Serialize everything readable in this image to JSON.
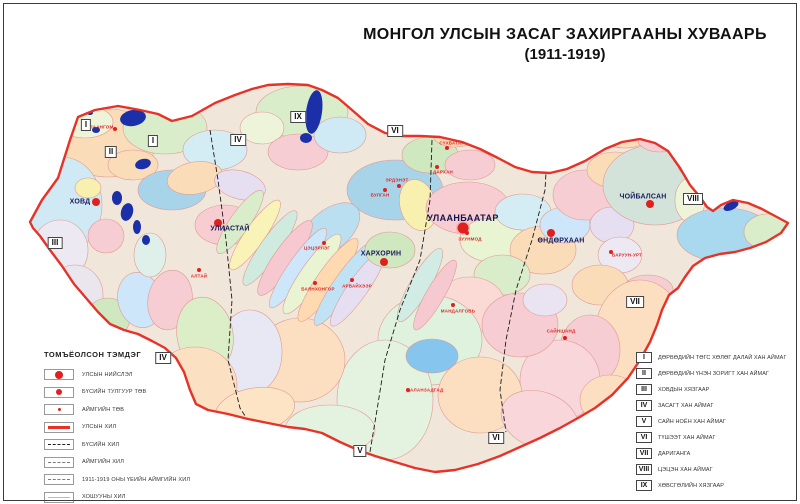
{
  "title": {
    "line1": "МОНГОЛ УЛСЫН ЗАСАГ ЗАХИРГААНЫ ХУВААРЬ",
    "line2": "(1911-1919)"
  },
  "colors": {
    "state_border": "#e63229",
    "city_dot": "#e01f1f",
    "aimag_label": "#e02525",
    "lake": "#1a2fa8"
  },
  "map": {
    "cities": [
      {
        "name": "УЛААНБААТАР",
        "type": "capital",
        "x": 463,
        "y": 228,
        "lx": 463,
        "ly": 218
      },
      {
        "name": "ХОВД",
        "type": "regional",
        "x": 96,
        "y": 202,
        "lx": 80,
        "ly": 202
      },
      {
        "name": "УЛИАСТАЙ",
        "type": "regional",
        "x": 218,
        "y": 223,
        "lx": 230,
        "ly": 229
      },
      {
        "name": "ХАРХОРИН",
        "type": "regional",
        "x": 384,
        "y": 262,
        "lx": 381,
        "ly": 254
      },
      {
        "name": "ӨНДӨРХААН",
        "type": "regional",
        "x": 551,
        "y": 233,
        "lx": 561,
        "ly": 241
      },
      {
        "name": "ЧОЙБАЛСАН",
        "type": "regional",
        "x": 650,
        "y": 204,
        "lx": 643,
        "ly": 197
      },
      {
        "name": "УЛААНГОМ",
        "type": "aimag",
        "x": 115,
        "y": 129,
        "lx": 100,
        "ly": 127
      },
      {
        "name": "АЛТАЙ",
        "type": "aimag",
        "x": 199,
        "y": 270,
        "lx": 199,
        "ly": 276
      },
      {
        "name": "ЦЭЦЭРЛЭГ",
        "type": "aimag",
        "x": 324,
        "y": 243,
        "lx": 317,
        "ly": 248
      },
      {
        "name": "БАЯНХОНГОР",
        "type": "aimag",
        "x": 315,
        "y": 283,
        "lx": 318,
        "ly": 289
      },
      {
        "name": "АРВАЙХЭЭР",
        "type": "aimag",
        "x": 352,
        "y": 280,
        "lx": 357,
        "ly": 286
      },
      {
        "name": "БУЛГАН",
        "type": "aimag",
        "x": 385,
        "y": 190,
        "lx": 380,
        "ly": 195
      },
      {
        "name": "ЭРДЭНЭТ",
        "type": "aimag",
        "x": 399,
        "y": 186,
        "lx": 397,
        "ly": 180
      },
      {
        "name": "СҮХБАТАР",
        "type": "aimag",
        "x": 447,
        "y": 148,
        "lx": 452,
        "ly": 143
      },
      {
        "name": "ДАРХАН",
        "type": "aimag",
        "x": 437,
        "y": 167,
        "lx": 443,
        "ly": 172
      },
      {
        "name": "ЗУУНМОД",
        "type": "aimag",
        "x": 467,
        "y": 233,
        "lx": 470,
        "ly": 239
      },
      {
        "name": "МАНДАЛГОВЬ",
        "type": "aimag",
        "x": 453,
        "y": 305,
        "lx": 458,
        "ly": 311
      },
      {
        "name": "САЙНШАНД",
        "type": "aimag",
        "x": 565,
        "y": 338,
        "lx": 561,
        "ly": 331
      },
      {
        "name": "ДАЛАНЗАДГАД",
        "type": "aimag",
        "x": 408,
        "y": 390,
        "lx": 425,
        "ly": 390
      },
      {
        "name": "БАРУУН-УРТ",
        "type": "aimag",
        "x": 611,
        "y": 252,
        "lx": 627,
        "ly": 255
      }
    ],
    "numerals": [
      {
        "n": "I",
        "x": 86,
        "y": 125
      },
      {
        "n": "II",
        "x": 111,
        "y": 152
      },
      {
        "n": "I",
        "x": 153,
        "y": 141
      },
      {
        "n": "III",
        "x": 55,
        "y": 243
      },
      {
        "n": "IV",
        "x": 238,
        "y": 140
      },
      {
        "n": "IX",
        "x": 298,
        "y": 117
      },
      {
        "n": "VI",
        "x": 395,
        "y": 131
      },
      {
        "n": "VIII",
        "x": 693,
        "y": 199
      },
      {
        "n": "VII",
        "x": 635,
        "y": 302
      },
      {
        "n": "IV",
        "x": 163,
        "y": 358
      },
      {
        "n": "V",
        "x": 360,
        "y": 451
      },
      {
        "n": "VI",
        "x": 496,
        "y": 438
      }
    ]
  },
  "legend_symbols": {
    "title": "ТОМЪЁОЛСОН ТЭМДЭГ",
    "items": [
      {
        "symbol": "dot-large",
        "label": "УЛСЫН НИЙСЛЭЛ"
      },
      {
        "symbol": "dot-medium",
        "label": "БҮСИЙН ТУЛГУУР ТӨВ"
      },
      {
        "symbol": "dot-small",
        "label": "АЙМГИЙН ТӨВ"
      },
      {
        "symbol": "line-state",
        "label": "УЛСЫН ХИЛ"
      },
      {
        "symbol": "line-region",
        "label": "БҮСИЙН ХИЛ"
      },
      {
        "symbol": "line-aimag",
        "label": "АЙМГИЙН ХИЛ"
      },
      {
        "symbol": "line-1911",
        "label": "1911-1919 ОНЫ ҮЕИЙН АЙМГИЙН ХИЛ"
      },
      {
        "symbol": "line-khoshuu",
        "label": "ХОШУУНЫ ХИЛ"
      }
    ]
  },
  "legend_regions": {
    "items": [
      {
        "numeral": "I",
        "label": "ДӨРВӨДИЙН ТӨГС ХӨЛӨГ ДАЛАЙ ХАН АЙМАГ"
      },
      {
        "numeral": "II",
        "label": "ДӨРВӨДИЙН ҮНЭН ЗОРИГТ ХАН АЙМАГ"
      },
      {
        "numeral": "III",
        "label": "ХОВДЫН ХЯЗГААР"
      },
      {
        "numeral": "IV",
        "label": "ЗАСАГТ ХАН АЙМАГ"
      },
      {
        "numeral": "V",
        "label": "САЙН НОЁН ХАН АЙМАГ"
      },
      {
        "numeral": "VI",
        "label": "ТҮШЭЭТ ХАН АЙМАГ"
      },
      {
        "numeral": "VII",
        "label": "ДАРИГАНГА"
      },
      {
        "numeral": "VIII",
        "label": "ЦЭЦЭН ХАН АЙМАГ"
      },
      {
        "numeral": "IX",
        "label": "ХӨВСГӨЛИЙН ХЯЗГААР"
      }
    ]
  }
}
